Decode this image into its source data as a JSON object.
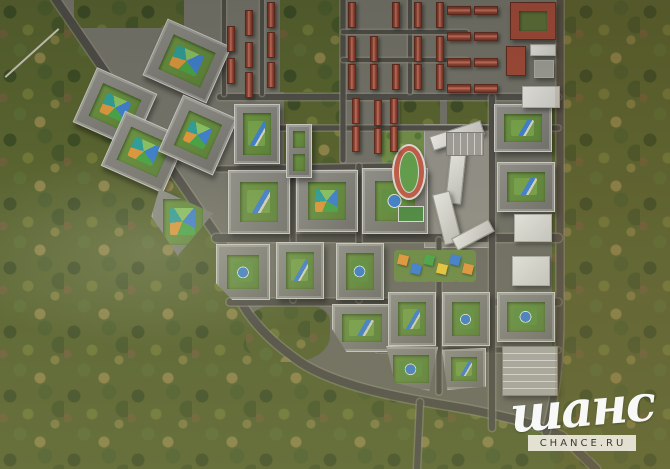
{
  "watermark": {
    "script_text": "шанс",
    "box_text": "CHANCE.RU"
  },
  "palette": {
    "forest": "#57622f",
    "road": "#4f4d47",
    "road_edge": "#8f8c7b",
    "dev_ground": "#6f6e63",
    "building_wall": "#8f8e87",
    "building_trim": "#c9c8c0",
    "courtyard_green": "#6d9343",
    "play_blue": "#3f7fd0",
    "play_green": "#49a447",
    "play_orange": "#e0973c",
    "red_roof": "#9e4a38",
    "white_building": "#d9d8d2",
    "track_red": "#bd5b47",
    "field_green": "#619b4a",
    "garage_gray": "#a8a7a1"
  },
  "features": {
    "blocks": [
      {
        "id": "courtyard-block-a",
        "x": 82,
        "y": 78,
        "w": 66,
        "h": 60,
        "rot": 24,
        "play": "multi"
      },
      {
        "id": "courtyard-block-b",
        "x": 152,
        "y": 30,
        "w": 70,
        "h": 62,
        "rot": 24,
        "play": "multi"
      },
      {
        "id": "courtyard-block-c",
        "x": 110,
        "y": 122,
        "w": 68,
        "h": 60,
        "rot": 24,
        "play": "multi"
      },
      {
        "id": "courtyard-block-d",
        "x": 168,
        "y": 104,
        "w": 60,
        "h": 62,
        "rot": 24,
        "play": "multi"
      },
      {
        "id": "triangle-block",
        "x": 150,
        "y": 186,
        "w": 66,
        "h": 72,
        "clip": "polygon(14% 4%, 96% 38%, 42% 97%, 2% 42%)",
        "play": "multi"
      },
      {
        "id": "grid-block-f",
        "x": 228,
        "y": 170,
        "w": 62,
        "h": 64,
        "play": "green"
      },
      {
        "id": "grid-block-g",
        "x": 296,
        "y": 170,
        "w": 62,
        "h": 62,
        "play": "multi"
      },
      {
        "id": "grid-block-h",
        "x": 362,
        "y": 168,
        "w": 66,
        "h": 66,
        "play": "blue"
      },
      {
        "id": "grid-block-i",
        "x": 216,
        "y": 244,
        "w": 54,
        "h": 56,
        "clip": "polygon(0 0,100% 0,100% 100%,30% 100%,0 70%)",
        "play": "blue"
      },
      {
        "id": "grid-block-j",
        "x": 276,
        "y": 242,
        "w": 48,
        "h": 57,
        "play": "green"
      },
      {
        "id": "grid-block-k",
        "x": 336,
        "y": 243,
        "w": 48,
        "h": 57,
        "play": "blue"
      },
      {
        "id": "grid-block-l",
        "x": 332,
        "y": 304,
        "w": 60,
        "h": 48,
        "clip": "polygon(0 0,100% 0,100% 100%,24% 100%,0 52%)",
        "play": "green"
      },
      {
        "id": "grid-block-n",
        "x": 388,
        "y": 292,
        "w": 48,
        "h": 54,
        "play": "green"
      },
      {
        "id": "grid-block-o",
        "x": 442,
        "y": 292,
        "w": 48,
        "h": 54,
        "play": "blue"
      },
      {
        "id": "south-block-p",
        "x": 384,
        "y": 346,
        "w": 54,
        "h": 46,
        "clip": "polygon(4% 0,100% 2%,84% 98%,20% 80%)",
        "play": "blue"
      },
      {
        "id": "south-block-q",
        "x": 442,
        "y": 348,
        "w": 44,
        "h": 42,
        "clip": "polygon(0 4%,100% 0,100% 92%,12% 100%)",
        "play": "green"
      },
      {
        "id": "north-tall-block",
        "x": 234,
        "y": 104,
        "w": 46,
        "h": 60,
        "play": "green"
      },
      {
        "id": "north-double-block",
        "x": 286,
        "y": 124,
        "w": 26,
        "h": 54,
        "play": "green",
        "double": true
      },
      {
        "id": "east-block-s",
        "x": 494,
        "y": 104,
        "w": 58,
        "h": 48,
        "play": "green"
      },
      {
        "id": "east-block-t",
        "x": 497,
        "y": 162,
        "w": 58,
        "h": 50,
        "play": "green"
      },
      {
        "id": "east-block-w",
        "x": 497,
        "y": 292,
        "w": 58,
        "h": 50,
        "play": "blue"
      }
    ],
    "white_buildings": [
      {
        "id": "public-building-r",
        "x": 522,
        "y": 86,
        "w": 38,
        "h": 22
      },
      {
        "id": "public-building-u",
        "x": 514,
        "y": 214,
        "w": 38,
        "h": 28
      },
      {
        "id": "public-building-v",
        "x": 512,
        "y": 256,
        "w": 38,
        "h": 30
      },
      {
        "id": "white-slab",
        "x": 530,
        "y": 44,
        "w": 26,
        "h": 12
      },
      {
        "id": "gray-slab",
        "x": 534,
        "y": 60,
        "w": 20,
        "h": 18,
        "bg": "#9b9a92"
      }
    ],
    "red_buildings": [
      {
        "id": "brick-u-building",
        "x": 510,
        "y": 2,
        "w": 46,
        "h": 38,
        "court": true
      },
      {
        "id": "brick-building-2",
        "x": 506,
        "y": 46,
        "w": 20,
        "h": 30
      }
    ],
    "school_slabs": [
      {
        "id": "school-wing-1",
        "x": 430,
        "y": 128,
        "w": 54,
        "h": 15,
        "rot": -18
      },
      {
        "id": "school-wing-2",
        "x": 448,
        "y": 146,
        "w": 16,
        "h": 58,
        "rot": 6
      },
      {
        "id": "school-wing-3",
        "x": 438,
        "y": 192,
        "w": 18,
        "h": 52,
        "rot": -14
      },
      {
        "id": "school-wing-4",
        "x": 452,
        "y": 228,
        "w": 42,
        "h": 14,
        "rot": -28
      }
    ],
    "stadium": {
      "x": 392,
      "y": 144,
      "w": 34,
      "h": 56
    },
    "sports_court": {
      "x": 398,
      "y": 206,
      "w": 26,
      "h": 16
    },
    "kindergarten": {
      "x": 394,
      "y": 250,
      "w": 82,
      "h": 32,
      "tents": [
        "#e0973c",
        "#3f7fd0",
        "#49a447",
        "#e8c43c",
        "#3f7fd0",
        "#e0973c"
      ]
    },
    "parking_lot": {
      "x": 446,
      "y": 132,
      "w": 38,
      "h": 24
    },
    "parking_garage": {
      "x": 502,
      "y": 346,
      "w": 56,
      "h": 50
    },
    "townhouses_v": [
      [
        227,
        26
      ],
      [
        227,
        58
      ],
      [
        245,
        10
      ],
      [
        245,
        42
      ],
      [
        245,
        72
      ],
      [
        267,
        2
      ],
      [
        267,
        32
      ],
      [
        267,
        62
      ],
      [
        348,
        2
      ],
      [
        392,
        2
      ],
      [
        414,
        2
      ],
      [
        436,
        2
      ],
      [
        348,
        36
      ],
      [
        370,
        36
      ],
      [
        414,
        36
      ],
      [
        436,
        36
      ],
      [
        348,
        64
      ],
      [
        370,
        64
      ],
      [
        392,
        64
      ],
      [
        414,
        64
      ],
      [
        436,
        64
      ],
      [
        352,
        98
      ],
      [
        352,
        126
      ],
      [
        374,
        100
      ],
      [
        374,
        128
      ],
      [
        390,
        98
      ],
      [
        390,
        126
      ]
    ],
    "townhouses_h": [
      [
        447,
        6
      ],
      [
        474,
        6
      ],
      [
        447,
        32
      ],
      [
        474,
        32
      ],
      [
        447,
        58
      ],
      [
        474,
        58
      ],
      [
        447,
        84
      ],
      [
        474,
        84
      ]
    ],
    "patches": [
      {
        "id": "grove-top-1",
        "x": 280,
        "y": 0,
        "w": 66,
        "h": 92,
        "kind": "forest"
      },
      {
        "id": "grove-top-2",
        "x": 284,
        "y": 92,
        "w": 56,
        "h": 72,
        "kind": "forest"
      },
      {
        "id": "grove-top-3",
        "x": 400,
        "y": 94,
        "w": 40,
        "h": 30,
        "kind": "forest"
      },
      {
        "id": "grove-top-4",
        "x": 447,
        "y": 94,
        "w": 42,
        "h": 32,
        "kind": "forest"
      },
      {
        "id": "grove-topleft",
        "x": 74,
        "y": 0,
        "w": 110,
        "h": 28,
        "kind": "forest"
      },
      {
        "id": "stadium-lawn",
        "x": 382,
        "y": 128,
        "w": 60,
        "h": 100,
        "kind": "lawn"
      },
      {
        "id": "grove-pocket",
        "x": 246,
        "y": 304,
        "w": 84,
        "h": 58,
        "kind": "forest",
        "round": true
      },
      {
        "id": "east-hedge",
        "x": 552,
        "y": 96,
        "w": 11,
        "h": 330,
        "kind": "forest"
      },
      {
        "id": "school-plaza",
        "x": 424,
        "y": 124,
        "w": 66,
        "h": 124,
        "kind": "pave"
      }
    ]
  },
  "roads": [
    {
      "d": "M 52,-6 L 224,246 C 230,298 254,330 300,362 C 346,392 430,402 472,410 C 512,418 536,424 562,436 L 596,469",
      "w": 8
    },
    {
      "d": "M 560,-4 L 560,312 C 560,372 554,400 546,432",
      "w": 7
    },
    {
      "d": "M 220,97 L 558,97",
      "w": 6
    },
    {
      "d": "M 220,128 L 558,128",
      "w": 5
    },
    {
      "d": "M 218,169 L 392,166",
      "w": 5
    },
    {
      "d": "M 216,238 L 558,238",
      "w": 8
    },
    {
      "d": "M 230,302 L 558,302",
      "w": 7
    },
    {
      "d": "M 378,350 L 558,350",
      "w": 5
    },
    {
      "d": "M 224,0 L 224,94",
      "w": 4
    },
    {
      "d": "M 262,0 L 262,94",
      "w": 4
    },
    {
      "d": "M 343,0 L 343,160",
      "w": 5
    },
    {
      "d": "M 410,0 L 410,92",
      "w": 4
    },
    {
      "d": "M 359,166 L 359,300",
      "w": 5
    },
    {
      "d": "M 293,166 L 293,300",
      "w": 5
    },
    {
      "d": "M 439,240 L 439,392",
      "w": 5
    },
    {
      "d": "M 492,97 L 492,428",
      "w": 6
    },
    {
      "d": "M 420,402 L 417,469",
      "w": 6
    },
    {
      "d": "M 343,32 L 466,32",
      "w": 4
    },
    {
      "d": "M 343,60 L 466,60",
      "w": 4
    }
  ]
}
